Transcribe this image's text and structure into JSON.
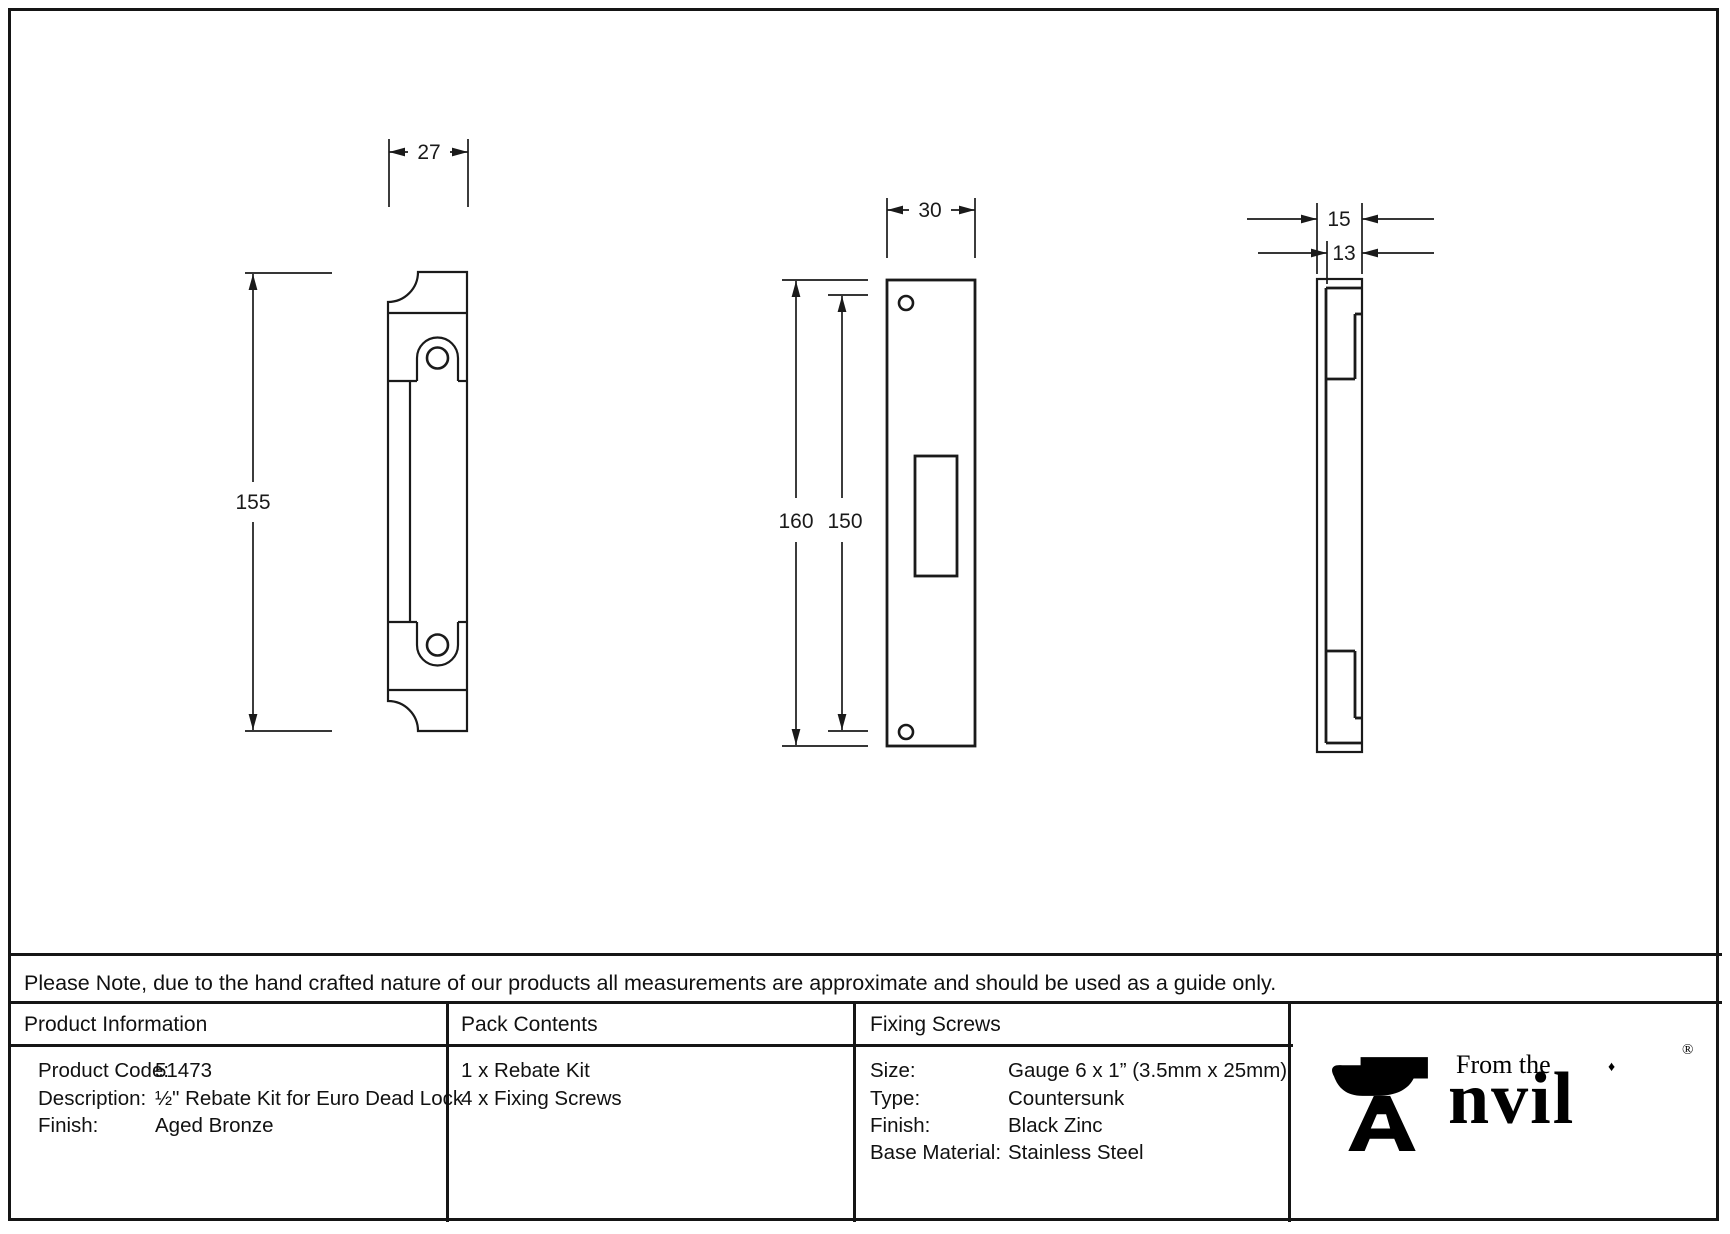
{
  "colors": {
    "line": "#1a1a1a",
    "background": "#ffffff"
  },
  "note": "Please Note, due to the hand crafted nature of our products all measurements are approximate and should be used as a guide only.",
  "drawings": {
    "front_view": {
      "width_dim": "27",
      "height_dim": "155"
    },
    "plate_view": {
      "width_dim": "30",
      "outer_height_dim": "160",
      "inner_height_dim": "150"
    },
    "side_view": {
      "outer_width_dim": "15",
      "inner_width_dim": "13"
    }
  },
  "table": {
    "product_information": {
      "header": "Product Information",
      "rows": [
        {
          "label": "Product Code:",
          "value": "51473"
        },
        {
          "label": "Description:",
          "value": "½\" Rebate Kit for Euro Dead Lock"
        },
        {
          "label": "Finish:",
          "value": "Aged Bronze"
        }
      ]
    },
    "pack_contents": {
      "header": "Pack Contents",
      "items": [
        "1 x Rebate Kit",
        "4 x Fixing Screws"
      ]
    },
    "fixing_screws": {
      "header": "Fixing Screws",
      "rows": [
        {
          "label": "Size:",
          "value": "Gauge 6 x 1” (3.5mm x 25mm)"
        },
        {
          "label": "Type:",
          "value": "Countersunk"
        },
        {
          "label": "Finish:",
          "value": "Black Zinc"
        },
        {
          "label": "Base Material:",
          "value": "Stainless Steel"
        }
      ]
    }
  },
  "logo": {
    "tagline": "From the",
    "brand_rest": "nvil",
    "diamond": "♦",
    "registered": "®",
    "icon": "anvil-icon"
  }
}
